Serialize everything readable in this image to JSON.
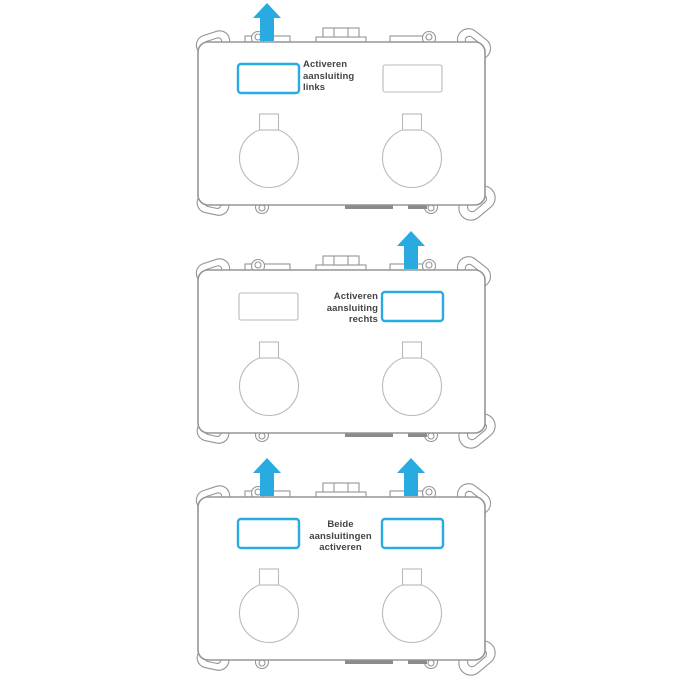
{
  "document": {
    "type": "instruction-diagram",
    "background": "#ffffff"
  },
  "colors": {
    "accent": "#29ABE2",
    "outline": "#939598",
    "detail": "#b7b9bb",
    "text": "#454547",
    "dark_tab": "#898b8e"
  },
  "units": [
    {
      "id": "top",
      "caption": "Activeren\naansluiting\nlinks",
      "highlighted_slot": "left",
      "arrows": [
        "left"
      ]
    },
    {
      "id": "middle",
      "caption": "Activeren\naansluiting\nrechts",
      "highlighted_slot": "right",
      "arrows": [
        "right"
      ]
    },
    {
      "id": "bottom",
      "caption": "Beide\naansluitingen\nactiveren",
      "highlighted_slot": "both",
      "arrows": [
        "left",
        "right"
      ]
    }
  ]
}
